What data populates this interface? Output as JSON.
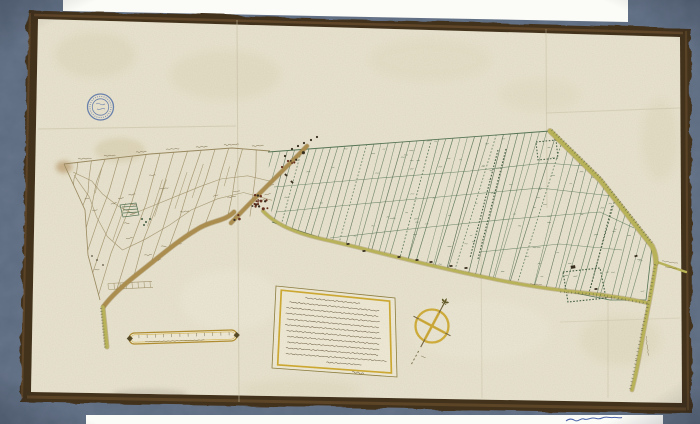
{
  "document": {
    "kind": "photograph of a 17th-century manuscript polder map on vellum",
    "text_legibility": "all handwriting illegible at this resolution"
  },
  "colors": {
    "bg_blue": "#5c6b7f",
    "paper_white": "#fbfbf7",
    "frame_dark": "#43321f",
    "frame_light": "#7d5a35",
    "parchment": "#e9e4d0",
    "parchment_light": "#f0ecdd",
    "stain": "#d3c8a5",
    "ink_sepia": "#97865c",
    "ink_sepia_dark": "#6f5f3c",
    "ink_green": "#4e7050",
    "ink_green_dark": "#3a573f",
    "road_tan": "#ab8c4b",
    "road_tan_dark": "#8a6c34",
    "road_yellow": "#b9b455",
    "hatch_green": "#4f5a33",
    "gold": "#b08b28",
    "gold_bright": "#cfa92c",
    "stamp_blue": "#4465a8",
    "dot_red": "#5f2715",
    "dot_black": "#2e2417",
    "crease": "#c6bda2",
    "note_blue": "#4a62a8",
    "cartouche_fill": "#f0ebd7",
    "text_ink": "#55452a"
  },
  "counts": {
    "east_strip_lines": 55,
    "parcel_number_marks": 85,
    "west_transverse_lines": 14,
    "west_label_marks": 24,
    "top_boundary_labels": 7,
    "village_house_dots": 26,
    "scale_bar_ticks": 12
  },
  "cartouche": {
    "text_lines": 12,
    "border": "double, gold inner line"
  },
  "scale_bar": {
    "shape": "capsule with dark end knobs",
    "caption_lines": 1
  },
  "compass": {
    "pointer_mark": "fleur-de-lis",
    "ring_color": "gold"
  },
  "stamp": {
    "shape": "small circular archive stamp",
    "rings": 2
  }
}
